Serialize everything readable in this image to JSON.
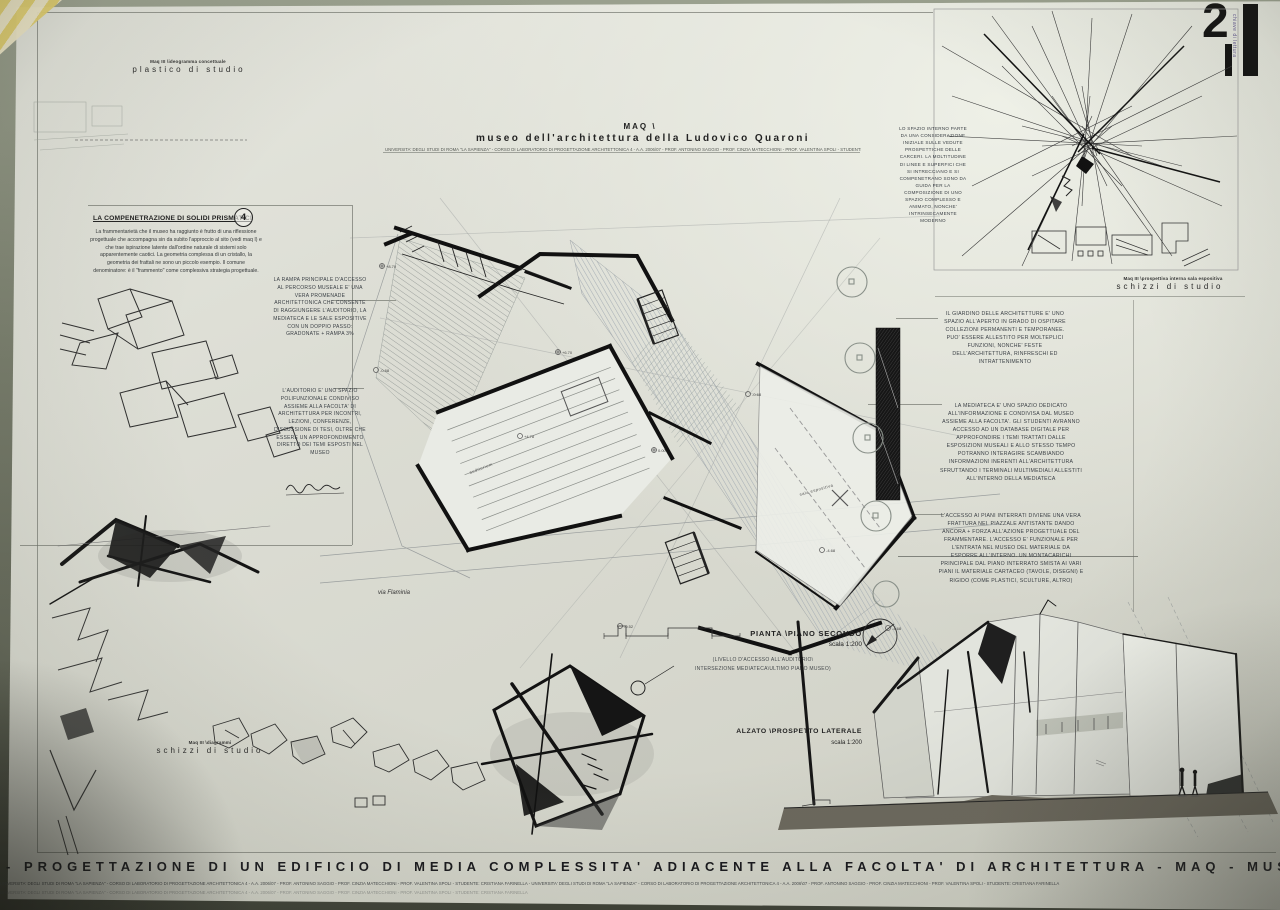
{
  "corner": {
    "page_number": "2",
    "side_label": "chiave di lettura"
  },
  "top_left": {
    "series_caption": "Maq III \\ideogramma concettuale",
    "caption": "plastico di studio"
  },
  "title_block": {
    "acronym": "MAQ \\",
    "title": "museo dell'architettura della Ludovico Quaroni",
    "credits": "UNIVERSITA' DEGLI STUDI DI ROMA \"LA SAPIENZA\" - CORSO DI LABORATORIO DI PROGETTAZIONE ARCHITETTONICA 4 - A.A. 2006\\07 - PROF. ANTONINO SAGGIO - PROF. CINZIA MATECCHIONI - PROF. VALENTINA SPOLI - STUDENTE: CRISTIANA FARINELLA"
  },
  "concept_panel": {
    "series_caption": "Maq III \\prospettiva interna sala espositiva",
    "caption": "schizzi di studio",
    "note": "LO SPAZIO INTERNO PARTE DA UNA CONSIDERAZIONE INIZIALE SULLE VEDUTE PROSPETTICHE DELLE CARCERI. LA MOLTITUDINE DI LINEE E SUPERFICI CHE SI INTRECCIANO E SI COMPENETRANO SONO DA GUIDA PER LA COMPOSIZIONE DI UNO SPAZIO COMPLESSO E ANIMATO, NONCHE' INTRINSECAMENTE MODERNO"
  },
  "left_panel": {
    "title": "LA COMPENETRAZIONE DI SOLIDI PRISMATICI",
    "badge": "4",
    "body": "La frammentarietà che il museo ha raggiunto è frutto di una riflessione progettuale che accompagna sin da subito l'approccio al sito (vedi maq I) e che trae ispirazione latente dall'ordine naturale di sistemi solo apparentemente caotici. La geometria complessa di un cristallo, la geometria dei frattali ne sono un piccolo esempio. Il comune denominatore: è il \"frammento\" come complessiva strategia progettuale."
  },
  "left_notes": [
    {
      "text": "LA RAMPA PRINCIPALE D'ACCESSO AL PERCORSO MUSEALE E' UNA VERA PROMENADE ARCHITETTONICA CHE CONSENTE DI RAGGIUNGERE L'AUDITORIO, LA MEDIATECA E LE SALE ESPOSITIVE CON UN DOPPIO PASSO: GRADONATE + RAMPA 3%"
    },
    {
      "text": "L'AUDITORIO E' UNO SPAZIO POLIFUNZIONALE CONDIVISO ASSIEME ALLA FACOLTA' DI ARCHITETTURA PER INCONTRI, LEZIONI, CONFERENZE, DISCUSSIONE DI TESI, OLTRE CHE ESSERE UN APPROFONDIMENTO DIRETTO DEI TEMI ESPOSTI NEL MUSEO"
    }
  ],
  "right_notes": [
    {
      "text": "IL GIARDINO DELLE ARCHITETTURE E' UNO SPAZIO ALL'APERTO IN GRADO DI OSPITARE COLLEZIONI PERMANENTI E TEMPORANEE. PUO' ESSERE ALLESTITO PER MOLTEPLICI FUNZIONI, NONCHE' FESTE DELL'ARCHITETTURA, RINFRESCHI ED INTRATTENIMENTO"
    },
    {
      "text": "LA MEDIATECA E' UNO SPAZIO DEDICATO ALL'INFORMAZIONE E CONDIVISA DAL MUSEO ASSIEME ALLA FACOLTA'. GLI STUDENTI AVRANNO ACCESSO AD UN DATABASE DIGITALE PER APPROFONDIRE I TEMI TRATTATI DALLE ESPOSIZIONI MUSEALI E ALLO STESSO TEMPO POTRANNO INTERAGIRE SCAMBIANDO INFORMAZIONI INERENTI ALL'ARCHITETTURA SFRUTTANDO I TERMINALI MULTIMEDIALI ALLESTITI ALL'INTERNO DELLA MEDIATECA"
    },
    {
      "text": "L'ACCESSO AI PIANI INTERRATI DIVIENE UNA VERA FRATTURA NEL PIAZZALE ANTISTANTE DANDO ANCORA + FORZA ALL'AZIONE PROGETTUALE DEL FRAMMENTARE. L'ACCESSO E' FUNZIONALE PER L'ENTRATA NEL MUSEO DEL MATERIALE DA ESPORRE ALL'INTERNO. UN MONTACARICHI PRINCIPALE DAL PIANO INTERRATO SMISTA AI VARI PIANI IL MATERIALE CARTACEO (TAVOLE, DISEGNI) E RIGIDO (COME PLASTICI, SCULTURE, ALTRO)"
    }
  ],
  "plan": {
    "street": "via Flaminia",
    "label": "PIANTA \\PIANO SECONDO",
    "scale": "scala 1:200",
    "note_line1": "(LIVELLO D'ACCESSO ALL'AUDITORIO\\",
    "note_line2": "INTERSEZIONE MEDIATECA\\ULTIMO PIANO MUSEO)",
    "rooms": [
      "auditorium",
      "sala espositiva"
    ],
    "levels": [
      "+8.70",
      "+6.70",
      "+4.78",
      "0.00",
      "-0.68",
      "-0.68",
      "-4.68",
      "-4.68",
      "-0.52"
    ]
  },
  "bottom_left": {
    "series_caption": "Maq III \\diagrammi",
    "caption": "schizzi di studio"
  },
  "elevation": {
    "label": "ALZATO \\PROSPETTO LATERALE",
    "scale": "scala 1:200"
  },
  "footer": {
    "banner": "- PROGETTAZIONE DI UN EDIFICIO DI MEDIA COMPLESSITA'  ADIACENTE ALLA FACOLTA' DI ARCHITETTURA - MAQ - MUSEO DI ARCHITETTURA DELLA LUDOVICO QUARONI - ROMA - 0"
  },
  "colors": {
    "paper": "#d9dad1",
    "ink": "#1b1b1b",
    "note_ink": "#3b4046",
    "wall": "#7d8271",
    "tape_yellow": "#e5d06d"
  }
}
